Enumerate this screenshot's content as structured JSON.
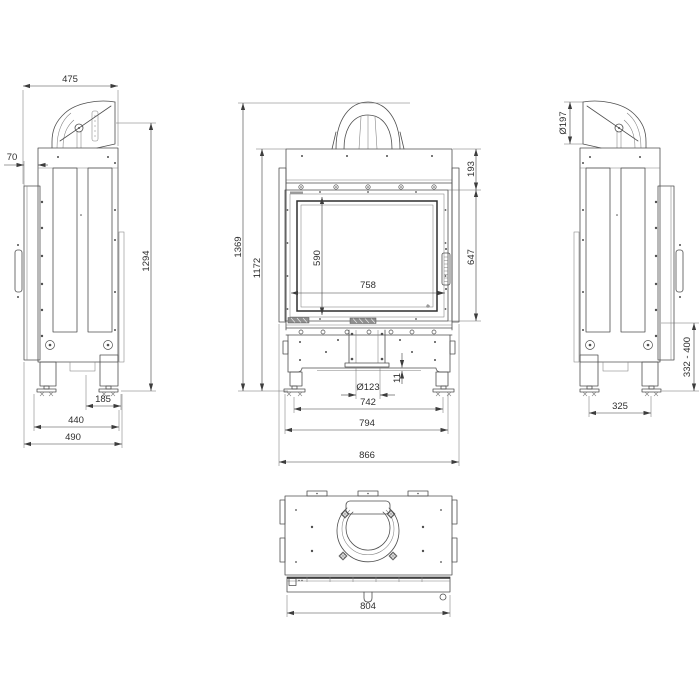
{
  "drawing": {
    "background": "#ffffff",
    "line_color": "#4f4f4f",
    "dim_color": "#2e2e2e",
    "views": {
      "side_left": {
        "label": "left-side-view",
        "dims": {
          "depth": "475",
          "door_offset": "70",
          "flue_axis_height": "1294",
          "foot_inset": "185",
          "foot_span": "440",
          "total_depth": "490"
        }
      },
      "front": {
        "label": "front-view",
        "dims": {
          "total_height": "1369",
          "body_height": "1172",
          "top_panel_height": "193",
          "glass_height": "590",
          "glass_width": "758",
          "door_height": "647",
          "outlet_diameter": "Ø123",
          "lip_height": "11",
          "foot_axis_span": "742",
          "foot_plate_span": "794",
          "overall_width": "866"
        }
      },
      "side_right": {
        "label": "right-side-view",
        "dims": {
          "flue_diameter": "Ø197",
          "base_clearance_range": "332 - 400",
          "foot_spacing": "325"
        }
      },
      "top": {
        "label": "top-view",
        "dims": {
          "front_width": "804"
        }
      }
    }
  }
}
